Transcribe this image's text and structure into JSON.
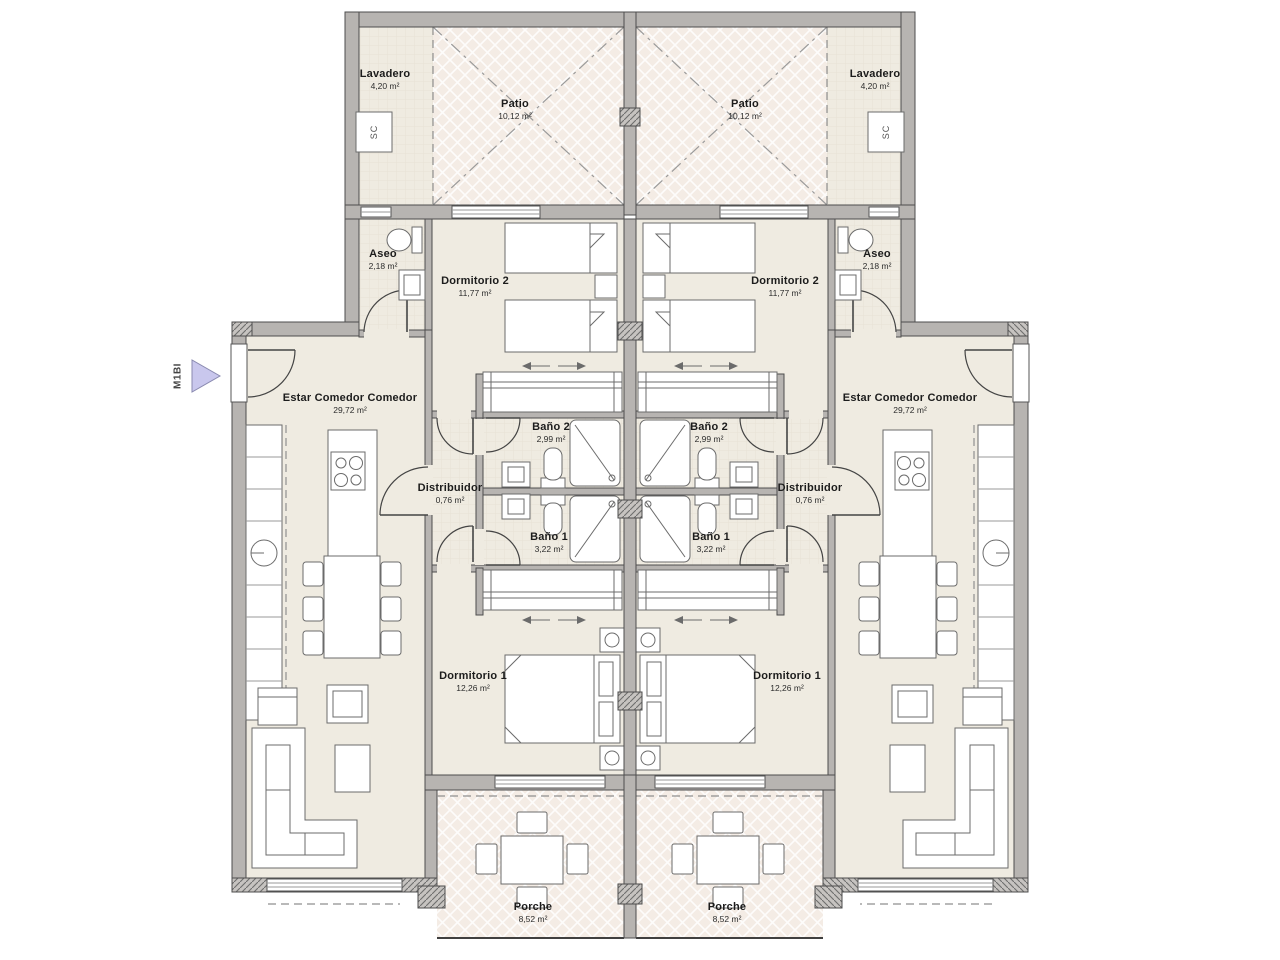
{
  "marker": {
    "label": "M1BI"
  },
  "fixtures": {
    "washer_label": "SC"
  },
  "rooms": {
    "lavadero": {
      "name": "Lavadero",
      "area": "4,20 m²"
    },
    "patio": {
      "name": "Patio",
      "area": "10,12 m²"
    },
    "aseo": {
      "name": "Aseo",
      "area": "2,18 m²"
    },
    "dormitorio2": {
      "name": "Dormitorio 2",
      "area": "11,77 m²"
    },
    "estar": {
      "name": "Estar Comedor Comedor",
      "area": "29,72 m²"
    },
    "bano2": {
      "name": "Baño 2",
      "area": "2,99 m²"
    },
    "distribuidor": {
      "name": "Distribuidor",
      "area": "0,76 m²"
    },
    "bano1": {
      "name": "Baño 1",
      "area": "3,22 m²"
    },
    "dormitorio1": {
      "name": "Dormitorio 1",
      "area": "12,26 m²"
    },
    "porche": {
      "name": "Porche",
      "area": "8,52 m²"
    }
  },
  "colors": {
    "wall": "#b7b4b1",
    "room_fill": "#efebe1",
    "patio_fill": "#f4ece5",
    "marker_fill": "#c9c7ed",
    "line": "#4d4d4d"
  }
}
